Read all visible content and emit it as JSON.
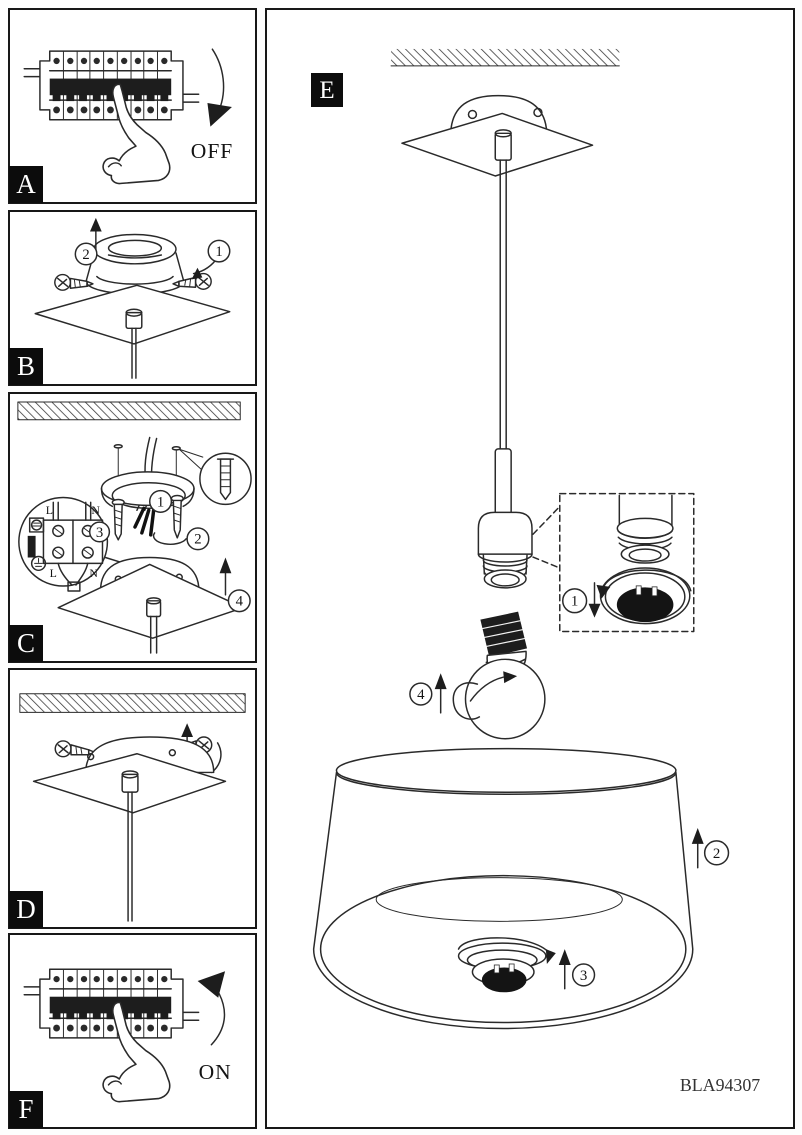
{
  "panel_a": {
    "label": "A",
    "state_label": "OFF"
  },
  "panel_b": {
    "label": "B",
    "step_unscrew": "1",
    "step_lift": "2"
  },
  "panel_c": {
    "label": "C",
    "step_insert_screws": "1",
    "step_connect_wires": "2",
    "step_terminal_detail": "3",
    "step_mount_plate": "4",
    "terminal": {
      "top_live": "L",
      "top_neutral": "N",
      "bottom_live": "L",
      "bottom_neutral": "N"
    }
  },
  "panel_d": {
    "label": "D"
  },
  "panel_e": {
    "label": "E",
    "step_shade_ring": "1",
    "step_raise_shade": "2",
    "step_lock_ring": "3",
    "step_insert_bulb": "4",
    "part_number": "BLA94307"
  },
  "panel_f": {
    "label": "F",
    "state_label": "ON"
  }
}
